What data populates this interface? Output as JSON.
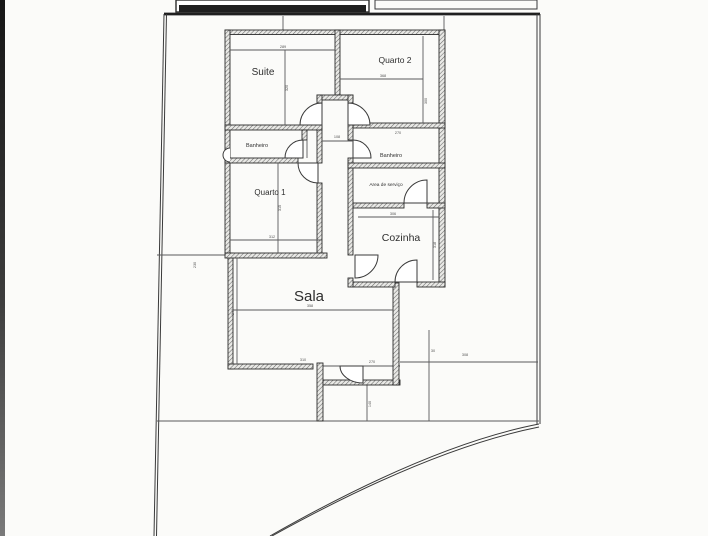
{
  "plan": {
    "type": "residential-floor-plan",
    "rooms": {
      "suite": {
        "label": "Suite"
      },
      "quarto2": {
        "label": "Quarto 2"
      },
      "banheiro1": {
        "label": "Banheiro"
      },
      "banheiro2": {
        "label": "Banheiro"
      },
      "quarto1": {
        "label": "Quarto 1"
      },
      "servico": {
        "label": "Area de serviço"
      },
      "cozinha": {
        "label": "Cozinha"
      },
      "sala": {
        "label": "Sala"
      }
    },
    "dimensions": {
      "suite_w": "289",
      "suite_h": "320",
      "quarto2_w": "368",
      "quarto2_h": "300",
      "corridor_w": "108",
      "banheiro2_w": "270",
      "quarto1_w": "312",
      "quarto1_h": "315",
      "cozinha_w": "306",
      "cozinha_h": "318",
      "sala_w": "358",
      "sala_h": "240",
      "sala_bottom_w": "310",
      "entry_w": "270",
      "terrace_w": "308",
      "terrace_tick": "30",
      "walkway_h": "140",
      "sideyard_w": "230"
    },
    "colors": {
      "background": "#fbfbf9",
      "wall": "#2c2c2c",
      "boundary": "#3a3a3a",
      "dimension_text": "#555555",
      "scan_edge": "#1c1c1c"
    }
  }
}
